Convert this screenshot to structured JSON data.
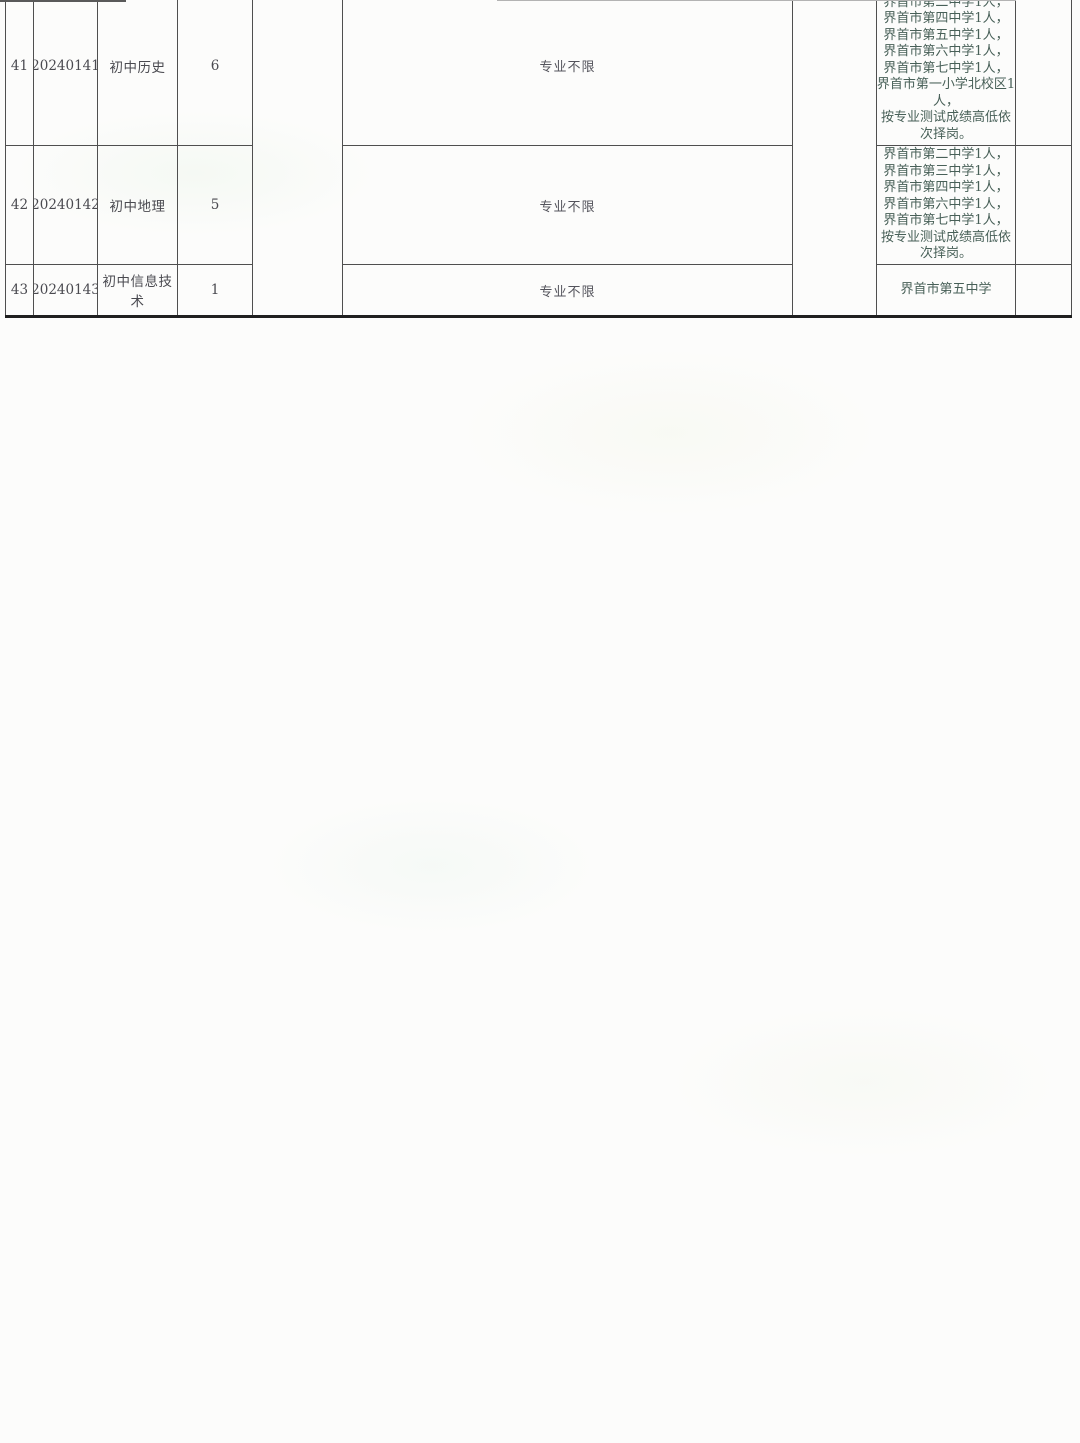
{
  "document": {
    "type": "scanned-recruitment-position-table",
    "colors": {
      "background": "#fcfcfb",
      "grid_border": "#4f4f4f",
      "bottom_border": "#1f1f1f",
      "text_main": "#4a4a50",
      "text_major": "#54545c",
      "text_school": "#486058"
    }
  },
  "table": {
    "rows": [
      {
        "seq": "41",
        "code": "20240141",
        "subject": "初中历史",
        "openings": "6",
        "major_requirement": "专业不限",
        "assignment_lines": [
          "界首市第二中学1人，",
          "界首市第四中学1人，",
          "界首市第五中学1人，",
          "界首市第六中学1人，",
          "界首市第七中学1人，",
          "界首市第一小学北校区1人，",
          "按专业测试成绩高低依次择岗。"
        ]
      },
      {
        "seq": "42",
        "code": "20240142",
        "subject": "初中地理",
        "openings": "5",
        "major_requirement": "专业不限",
        "assignment_lines": [
          "界首市第二中学1人，",
          "界首市第三中学1人，",
          "界首市第四中学1人，",
          "界首市第六中学1人，",
          "界首市第七中学1人，",
          "按专业测试成绩高低依次择岗。"
        ]
      },
      {
        "seq": "43",
        "code": "20240143",
        "subject": "初中信息技术",
        "openings": "1",
        "major_requirement": "专业不限",
        "assignment_lines": [
          "界首市第五中学"
        ]
      }
    ]
  }
}
